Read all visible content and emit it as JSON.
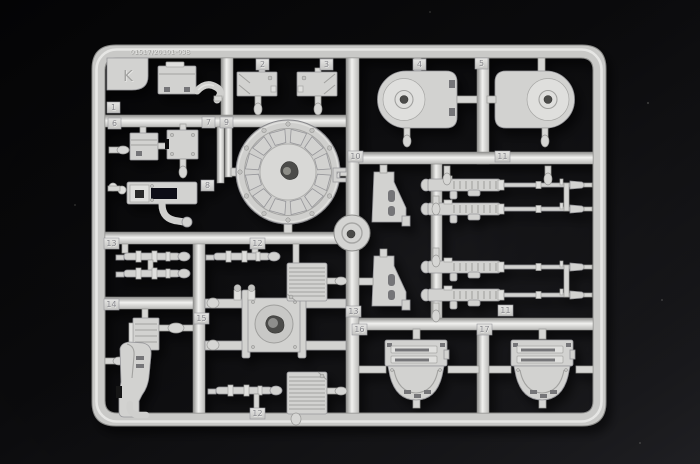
{
  "scene": {
    "subject": "Light-gray injection-molded plastic model kit sprue (parts runner) photographed on a black background",
    "colors": {
      "background": "#0a0a0c",
      "background_light_corner": "#26262a",
      "plastic": "#d2d2d0",
      "plastic_highlight": "#f1f1ef",
      "plastic_shadow": "#8e8e8c"
    }
  },
  "sprue": {
    "runner_letter": "K",
    "mold_code": "01517/20101-03B",
    "part_tabs": [
      "K",
      "1",
      "2",
      "3",
      "4",
      "5",
      "6",
      "7",
      "9",
      "8",
      "10",
      "11",
      "13",
      "12",
      "14",
      "15",
      "12",
      "13",
      "11",
      "16",
      "17"
    ]
  }
}
